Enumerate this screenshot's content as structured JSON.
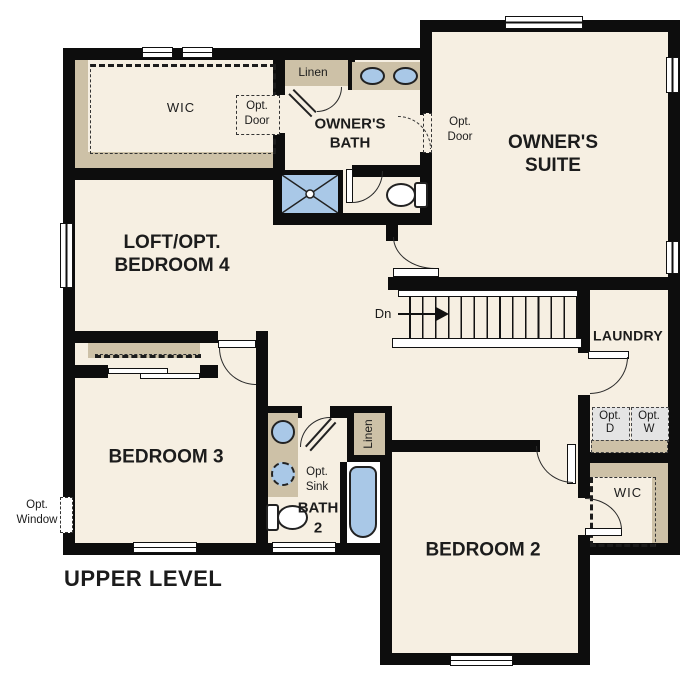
{
  "palette": {
    "wall": "#0d0d0d",
    "floor": "#f6efe2",
    "tan": "#cdc1a7",
    "blue": "#a9c8e7",
    "gray": "#e4e4e4"
  },
  "labels": {
    "title": "UPPER LEVEL",
    "wic_owner": "WIC",
    "opt_door_wic": "Opt.\nDoor",
    "linen_top": "Linen",
    "owners_bath": "OWNER'S\nBATH",
    "opt_door_suite": "Opt.\nDoor",
    "owners_suite": "OWNER'S\nSUITE",
    "loft": "LOFT/OPT.\nBEDROOM 4",
    "dn": "Dn",
    "laundry": "LAUNDRY",
    "opt_dryer": "Opt.\nD",
    "opt_washer": "Opt.\nW",
    "bedroom3": "BEDROOM 3",
    "opt_window": "Opt.\nWindow",
    "opt_sink": "Opt.\nSink",
    "bath2": "BATH\n2",
    "linen_bath2": "Linen",
    "wic_bedroom2": "WIC",
    "bedroom2": "BEDROOM 2"
  }
}
